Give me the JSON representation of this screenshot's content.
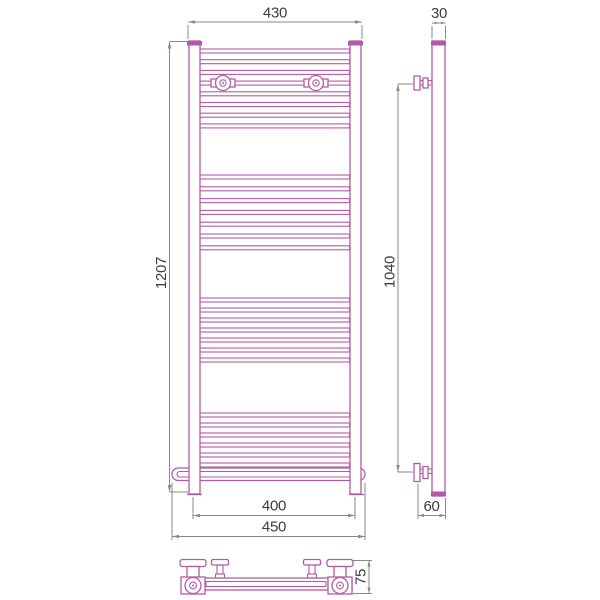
{
  "drawing": {
    "type": "technical-dimension-drawing",
    "subject": "ladder towel radiator shown in front, side and bottom views",
    "colors": {
      "outline": "#b45aa4",
      "dimension_line": "#8a8a8a",
      "dimension_text": "#3d3d3d",
      "background": "#ffffff"
    },
    "front_view": {
      "dims": {
        "width_top": "430",
        "height": "1207",
        "bottom_inner_width": "400",
        "bottom_outer_width": "450"
      },
      "rung_groups": [
        {
          "y_start": 49,
          "spacing": 10.7,
          "count": 8
        },
        {
          "y_start": 175,
          "spacing": 11.8,
          "count": 7
        },
        {
          "y_start": 298,
          "spacing": 10.0,
          "count": 7
        },
        {
          "y_start": 413,
          "spacing": 10.0,
          "count": 6
        }
      ]
    },
    "side_view": {
      "dims": {
        "depth_top": "30",
        "mount_height": "1040",
        "bottom_offset": "60"
      }
    },
    "bottom_view": {
      "dims": {
        "depth": "75"
      }
    }
  }
}
